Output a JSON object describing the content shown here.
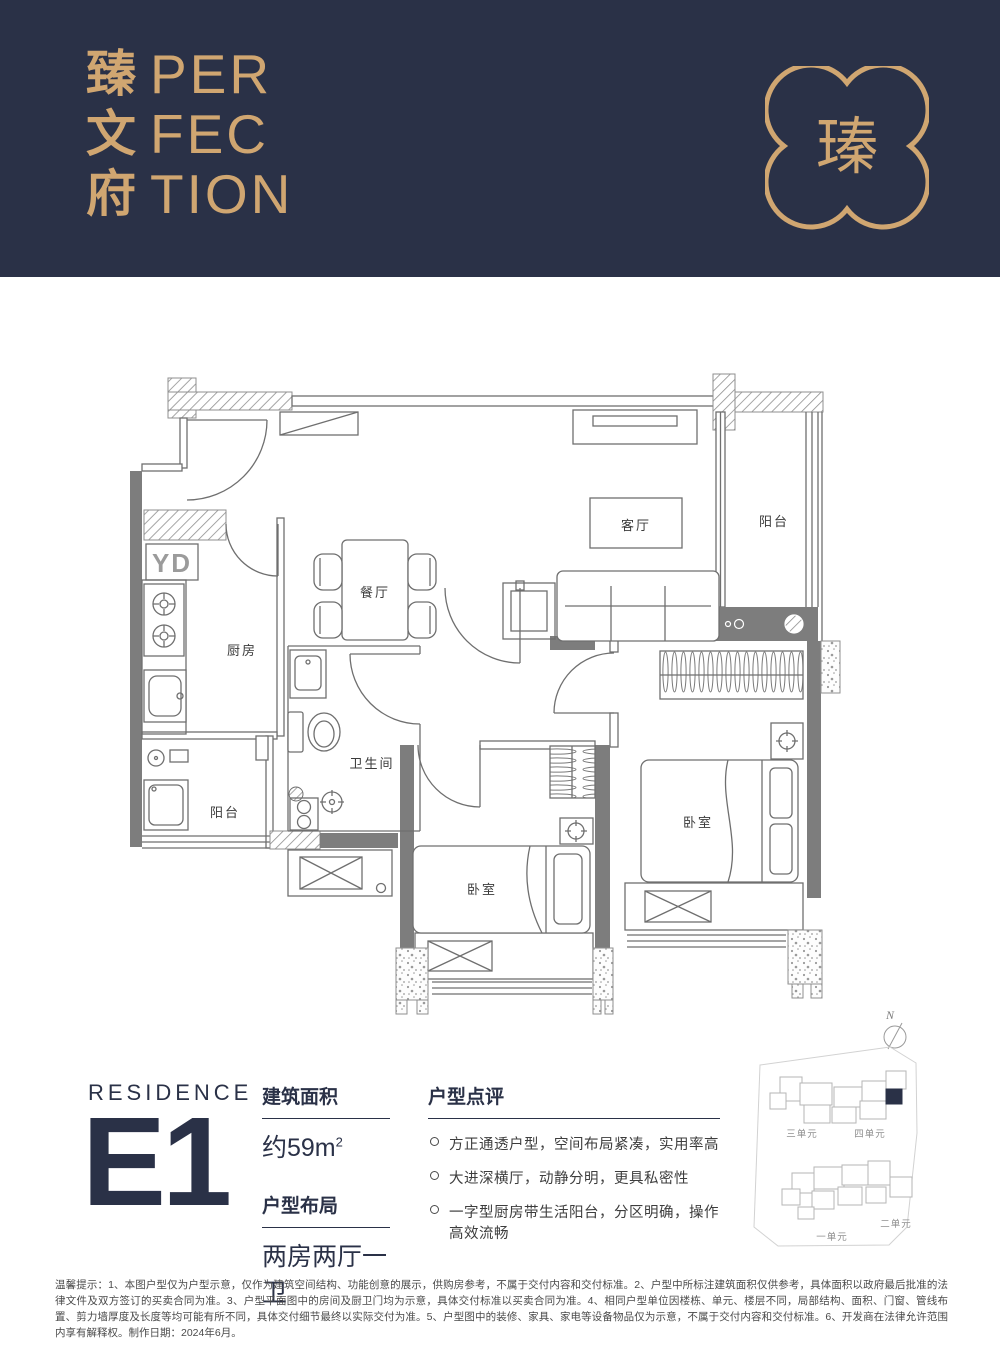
{
  "colors": {
    "navy": "#2a3147",
    "gold": "#d0a671",
    "wall_gray": "#7d7d7d",
    "line_gray": "#6f6f6f"
  },
  "header": {
    "brand_cn": "臻文府",
    "brand_cn_chars": [
      "臻",
      "文",
      "府"
    ],
    "brand_en_lines": [
      "PER",
      "FEC",
      "TION"
    ],
    "logo_glyph": "瑧"
  },
  "floorplan": {
    "appliance_label": "YD",
    "rooms": [
      {
        "id": "living",
        "label": "客厅"
      },
      {
        "id": "balcony-main",
        "label": "阳台"
      },
      {
        "id": "dining",
        "label": "餐厅"
      },
      {
        "id": "kitchen",
        "label": "厨房"
      },
      {
        "id": "balcony-service",
        "label": "阳台"
      },
      {
        "id": "bathroom",
        "label": "卫生间"
      },
      {
        "id": "bedroom-1",
        "label": "卧室"
      },
      {
        "id": "bedroom-2",
        "label": "卧室"
      }
    ]
  },
  "residence": {
    "eyebrow": "RESIDENCE",
    "unit": "E1"
  },
  "specs": [
    {
      "title": "建筑面积",
      "value": "约59m",
      "sup": "2"
    },
    {
      "title": "户型布局",
      "value": "两房两厅一卫"
    }
  ],
  "review": {
    "title": "户型点评",
    "bullets": [
      "方正通透户型，空间布局紧凑，实用率高",
      "大进深横厅，动静分明，更具私密性",
      "一字型厨房带生活阳台，分区明确，操作高效流畅"
    ]
  },
  "sitemap": {
    "north": "N",
    "units": [
      {
        "label": "三单元"
      },
      {
        "label": "四单元"
      },
      {
        "label": "一单元"
      },
      {
        "label": "二单元"
      }
    ]
  },
  "footer": {
    "text": "温馨提示：1、本图户型仅为户型示意，仅作为建筑空间结构、功能创意的展示，供购房参考，不属于交付内容和交付标准。2、户型中所标注建筑面积仅供参考，具体面积以政府最后批准的法律文件及双方签订的买卖合同为准。3、户型平面图中的房间及厨卫门均为示意，具体交付标准以买卖合同为准。4、相同户型单位因楼栋、单元、楼层不同，局部结构、面积、门窗、管线布置、剪力墙厚度及长度等均可能有所不同，具体交付细节最终以实际交付为准。5、户型图中的装修、家具、家电等设备物品仅为示意，不属于交付内容和交付标准。6、开发商在法律允许范围内享有解释权。制作日期：2024年6月。"
  }
}
